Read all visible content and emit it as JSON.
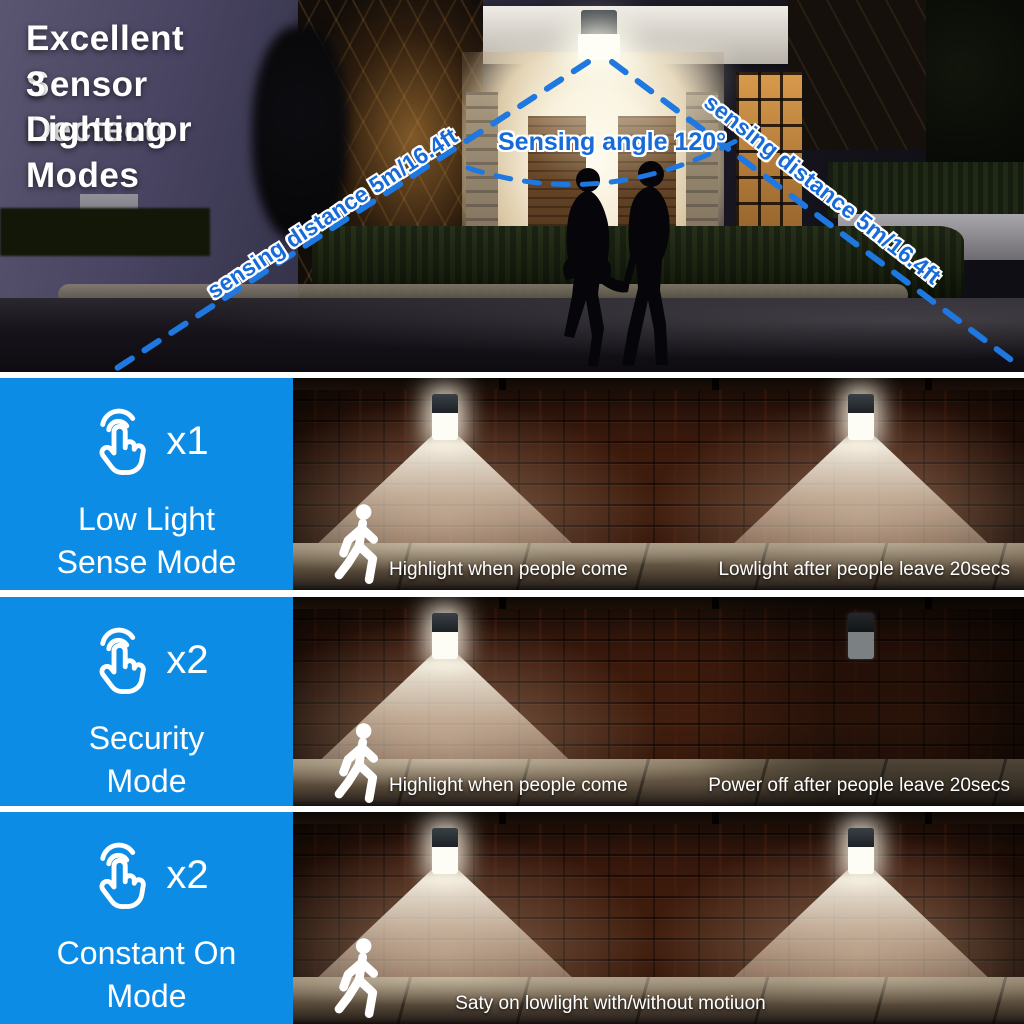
{
  "hero": {
    "title_line1": "Excellent Sensor Dectector",
    "title_line2": "3 Lighting Modes",
    "sensing_angle_label": "Sensing angle 120°",
    "sensing_distance_left": "sensing distance 5m/16.4ft",
    "sensing_distance_right": "sensing distance 5m/16.4ft"
  },
  "modes": [
    {
      "tap_count": "x1",
      "name_line1": "Low Light",
      "name_line2": "Sense Mode",
      "caption_left": "Highlight when people come",
      "caption_right": "Lowlight after people leave 20secs",
      "left_light": "on",
      "right_light": "on"
    },
    {
      "tap_count": "x2",
      "name_line1": "Security",
      "name_line2": "Mode",
      "caption_left": "Highlight when people come",
      "caption_right": "Power off after people leave 20secs",
      "left_light": "on",
      "right_light": "off"
    },
    {
      "tap_count": "x2",
      "name_line1": "Constant On",
      "name_line2": "Mode",
      "caption_center": "Saty on lowlight with/without motiuon",
      "left_light": "on",
      "right_light": "on"
    }
  ],
  "icons": {
    "tap": "tap-finger-icon",
    "walker": "walking-person-icon",
    "lamp": "sensor-light-icon"
  },
  "colors": {
    "accent_blue": "#0d8ce6",
    "dash_blue": "#1e78e0",
    "label_blue": "#176bd8",
    "text_white": "#ffffff",
    "brick_dark": "#2e150c"
  }
}
